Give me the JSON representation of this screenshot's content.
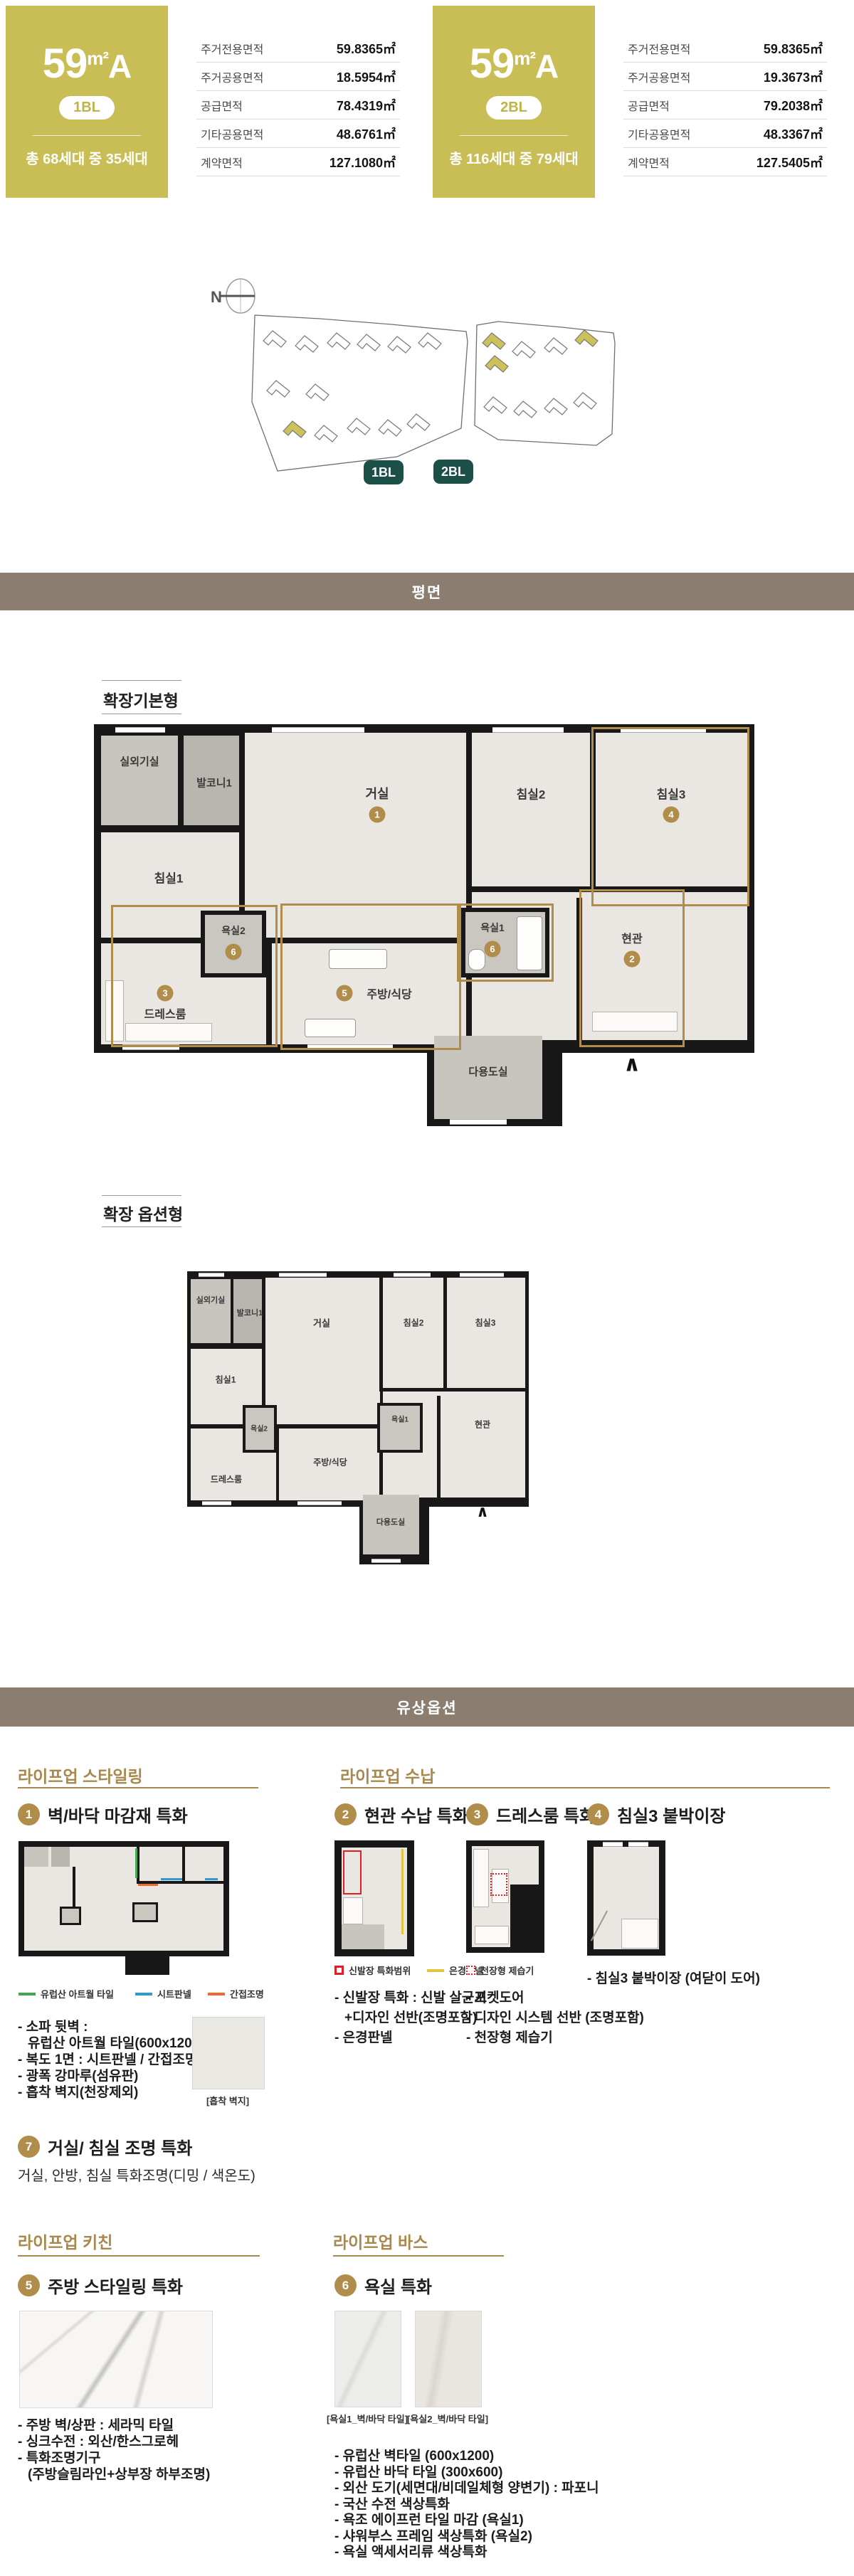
{
  "colors": {
    "olive": "#c9bd55",
    "gold": "#b08d4a",
    "teal": "#1d4f49",
    "section_bar": "#8b7e70",
    "accent_green": "#3eaa4d",
    "accent_blue": "#2e9ad2",
    "accent_orange": "#ea6a33",
    "accent_red": "#e01e25",
    "accent_yellow": "#e3c63e"
  },
  "unit_cards": [
    {
      "size": "59",
      "unit": "m²",
      "type": "A",
      "block": "1BL",
      "households": "총 68세대 중 35세대",
      "rows": [
        {
          "label": "주거전용면적",
          "value": "59.8365㎡"
        },
        {
          "label": "주거공용면적",
          "value": "18.5954㎡"
        },
        {
          "label": "공급면적",
          "value": "78.4319㎡"
        },
        {
          "label": "기타공용면적",
          "value": "48.6761㎡"
        },
        {
          "label": "계약면적",
          "value": "127.1080㎡"
        }
      ]
    },
    {
      "size": "59",
      "unit": "m²",
      "type": "A",
      "block": "2BL",
      "households": "총 116세대 중 79세대",
      "rows": [
        {
          "label": "주거전용면적",
          "value": "59.8365㎡"
        },
        {
          "label": "주거공용면적",
          "value": "19.3673㎡"
        },
        {
          "label": "공급면적",
          "value": "79.2038㎡"
        },
        {
          "label": "기타공용면적",
          "value": "48.3367㎡"
        },
        {
          "label": "계약면적",
          "value": "127.5405㎡"
        }
      ]
    }
  ],
  "site_plan": {
    "north": "N",
    "labels": [
      "1BL",
      "2BL"
    ]
  },
  "section_bars": {
    "plan": "평면",
    "options": "유상옵션"
  },
  "floor_plans": [
    {
      "title": "확장기본형",
      "entry_arrow": "∧",
      "rooms": {
        "ac": "실외기실",
        "balcony": "발코니1",
        "living": "거실",
        "bed1": "침실1",
        "bed2": "침실2",
        "bed3": "침실3",
        "bath1": "욕실1",
        "bath2": "욕실2",
        "entry": "현관",
        "dress": "드레스룸",
        "kitchen": "주방/식당",
        "utility": "다용도실"
      },
      "badges": {
        "living": "1",
        "entry": "2",
        "dress": "3",
        "bed3": "4",
        "kitchen": "5",
        "bath1": "6",
        "bath2": "6"
      }
    },
    {
      "title": "확장 옵션형",
      "entry_arrow": "∧",
      "rooms": {
        "ac": "실외기실",
        "balcony": "발코니1",
        "living": "거실",
        "bed1": "침실1",
        "bed2": "침실2",
        "bed3": "침실3",
        "bath1": "욕실1",
        "bath2": "욕실2",
        "entry": "현관",
        "dress": "드레스룸",
        "kitchen": "주방/식당",
        "utility": "다용도실"
      }
    }
  ],
  "option_groups": [
    {
      "title": "라이프업 스타일링",
      "items": [
        {
          "num": "1",
          "title": "벽/바닥 마감재 특화",
          "legend": [
            {
              "label": "유럽산 아트월 타일"
            },
            {
              "label": "시트판넬"
            },
            {
              "label": "간접조명"
            }
          ],
          "bullets": [
            "- 소파 뒷벽 :",
            "유럽산 아트월 타일(600x1200)",
            "- 복도 1면 : 시트판넬 / 간접조명",
            "- 광폭 강마루(섬유판)",
            "- 흡착 벽지(천장제외)"
          ],
          "swatch_caption": "[흡착 벽지]"
        },
        {
          "num": "7",
          "title": "거실/ 침실 조명 특화",
          "subtitle": "거실, 안방, 침실 특화조명(디밍 / 색온도)"
        }
      ]
    },
    {
      "title": "라이프업 수납",
      "items": [
        {
          "num": "2",
          "title": "현관 수납 특화",
          "legend": [
            {
              "label": "신발장 특화범위"
            },
            {
              "label": "은경판넬"
            }
          ],
          "bullets": [
            "- 신발장 특화 : 신발 살균기",
            "+디자인 선반(조명포함)",
            "- 은경판넬"
          ]
        },
        {
          "num": "3",
          "title": "드레스룸 특화",
          "legend": [
            {
              "label": "천장형 제습기"
            }
          ],
          "bullets": [
            "- 포켓도어",
            "- 디자인 시스템 선반 (조명포함)",
            "- 천장형 제습기"
          ]
        },
        {
          "num": "4",
          "title": "침실3 붙박이장",
          "bullets": [
            "- 침실3 붙박이장 (여닫이 도어)"
          ]
        }
      ]
    },
    {
      "title": "라이프업 키친",
      "items": [
        {
          "num": "5",
          "title": "주방 스타일링 특화",
          "bullets": [
            "- 주방 벽/상판 : 세라믹 타일",
            "- 싱크수전 : 외산/한스그로헤",
            "- 특화조명기구",
            "(주방슬림라인+상부장 하부조명)"
          ]
        }
      ]
    },
    {
      "title": "라이프업 바스",
      "items": [
        {
          "num": "6",
          "title": "욕실 특화",
          "swatches": [
            "[욕실1_벽/바닥 타일]",
            "[욕실2_벽/바닥 타일]"
          ],
          "bullets": [
            "- 유럽산 벽타일 (600x1200)",
            "- 유럽산 바닥 타일 (300x600)",
            "- 외산 도기(세면대/비데일체형 양변기) : 파포니",
            "- 국산 수전 색상특화",
            "- 욕조 에이프런 타일 마감 (욕실1)",
            "- 샤워부스 프레임 색상특화 (욕실2)",
            "- 욕실 액세서리류 색상특화"
          ]
        }
      ]
    }
  ]
}
